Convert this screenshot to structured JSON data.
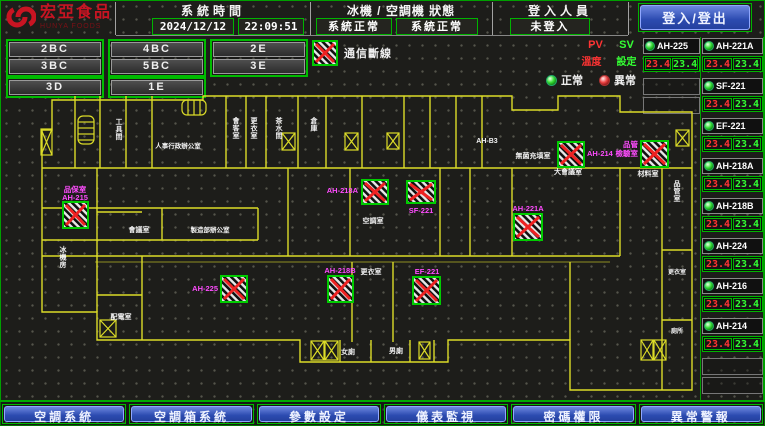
{
  "header": {
    "logo_title": "宏亞食品",
    "logo_subtitle": "HUNYA FOODS",
    "time_label": "系統時間",
    "date": "2024/12/12",
    "time": "22:09:51",
    "status_label": "冰機 / 空調機 狀態",
    "chiller_status": "系統正常",
    "ahu_status": "系統正常",
    "login_label": "登入人員",
    "login_status": "未登入",
    "login_button": "登入/登出"
  },
  "floor_buttons": {
    "groups": [
      [
        "2BC",
        "3BC"
      ],
      [
        "4BC",
        "5BC"
      ],
      [
        "2E",
        "3E"
      ]
    ],
    "row3": [
      "3D",
      "1E"
    ]
  },
  "legend": {
    "comm_lost": "通信斷線",
    "normal": "正常",
    "abnormal": "異常",
    "pv": "PV",
    "sv": "SV",
    "temp": "溫度",
    "set": "設定"
  },
  "equipment": {
    "col1": [
      {
        "name": "AH-225",
        "pv": "23.4",
        "sv": "23.4"
      }
    ],
    "col1_empty": 2,
    "col2": [
      {
        "name": "AH-221A",
        "pv": "23.4",
        "sv": "23.4"
      },
      {
        "name": "SF-221",
        "pv": "23.4",
        "sv": "23.4"
      },
      {
        "name": "EF-221",
        "pv": "23.4",
        "sv": "23.4"
      },
      {
        "name": "AH-218A",
        "pv": "23.4",
        "sv": "23.4"
      },
      {
        "name": "AH-218B",
        "pv": "23.4",
        "sv": "23.4"
      },
      {
        "name": "AH-224",
        "pv": "23.4",
        "sv": "23.4"
      },
      {
        "name": "AH-216",
        "pv": "23.4",
        "sv": "23.4"
      },
      {
        "name": "AH-214",
        "pv": "23.4",
        "sv": "23.4"
      }
    ],
    "col2_empty": 2
  },
  "bottom_nav": [
    "空調系統",
    "空調箱系統",
    "參數設定",
    "儀表監視",
    "密碼權限",
    "異常警報"
  ],
  "colors": {
    "accent_green": "#00bb00",
    "wall_yellow": "#dcdc28",
    "magenta": "#ff4cff",
    "pv_red": "#ff3333",
    "sv_green": "#33ff33"
  },
  "floorplan": {
    "room_labels": [
      {
        "t": "工具間",
        "x": 119,
        "y": 34,
        "v": true
      },
      {
        "t": "人事行政辦公室",
        "x": 178,
        "y": 58,
        "s": 6.5
      },
      {
        "t": "會客室",
        "x": 236,
        "y": 33,
        "v": true
      },
      {
        "t": "更衣室",
        "x": 254,
        "y": 33,
        "v": true
      },
      {
        "t": "茶水間",
        "x": 279,
        "y": 33,
        "v": true
      },
      {
        "t": "倉庫",
        "x": 314,
        "y": 33,
        "v": true
      },
      {
        "t": "AH-B3",
        "x": 487,
        "y": 53,
        "s": 7
      },
      {
        "t": "無菌充填室",
        "x": 533,
        "y": 68
      },
      {
        "t": "大會議室",
        "x": 568,
        "y": 84
      },
      {
        "t": "材料室",
        "x": 648,
        "y": 86
      },
      {
        "t": "品管室",
        "x": 677,
        "y": 96,
        "v": true
      },
      {
        "t": "會議室",
        "x": 139,
        "y": 142
      },
      {
        "t": "製造部辦公室",
        "x": 210,
        "y": 142,
        "s": 6.5
      },
      {
        "t": "空調室",
        "x": 373,
        "y": 133
      },
      {
        "t": "更衣室",
        "x": 371,
        "y": 184
      },
      {
        "t": "冰機房",
        "x": 63,
        "y": 162,
        "v": true
      },
      {
        "t": "配電室",
        "x": 121,
        "y": 229
      },
      {
        "t": "女廁",
        "x": 348,
        "y": 264
      },
      {
        "t": "男廁",
        "x": 396,
        "y": 263
      },
      {
        "t": "更衣室",
        "x": 677,
        "y": 184,
        "s": 6
      },
      {
        "t": "廁所",
        "x": 677,
        "y": 243,
        "s": 6
      }
    ],
    "markers": [
      {
        "id": "AH-215",
        "r": [
          63,
          112,
          25,
          26
        ],
        "labels": [
          {
            "t": "品保室",
            "x": 75,
            "y": 102
          },
          {
            "t": "AH-215",
            "x": 75,
            "y": 110
          }
        ]
      },
      {
        "id": "AH-225",
        "r": [
          221,
          186,
          26,
          26
        ],
        "labels": [
          {
            "t": "AH-225",
            "x": 218,
            "y": 201,
            "a": "end"
          }
        ]
      },
      {
        "id": "AH-218B",
        "r": [
          328,
          186,
          25,
          26
        ],
        "labels": [
          {
            "t": "AH-218B",
            "x": 340,
            "y": 183
          }
        ]
      },
      {
        "id": "EF-221",
        "r": [
          413,
          187,
          27,
          27
        ],
        "labels": [
          {
            "t": "EF-221",
            "x": 427,
            "y": 184
          }
        ]
      },
      {
        "id": "AH-218A",
        "r": [
          362,
          90,
          26,
          24
        ],
        "labels": [
          {
            "t": "AH-218A",
            "x": 358,
            "y": 103,
            "a": "end"
          }
        ]
      },
      {
        "id": "SF-221",
        "r": [
          407,
          91,
          28,
          22
        ],
        "labels": [
          {
            "t": "SF-221",
            "x": 421,
            "y": 123
          }
        ]
      },
      {
        "id": "AH-221A",
        "r": [
          514,
          124,
          28,
          26
        ],
        "labels": [
          {
            "t": "AH-221A",
            "x": 528,
            "y": 121
          }
        ]
      },
      {
        "id": "AH-214",
        "r": [
          558,
          52,
          26,
          25
        ],
        "labels": [
          {
            "t": "AH-214",
            "x": 587,
            "y": 66,
            "a": "start"
          }
        ]
      },
      {
        "id": "AH-216",
        "r": [
          641,
          51,
          27,
          26
        ],
        "labels": [
          {
            "t": "品管",
            "x": 638,
            "y": 57,
            "a": "end"
          },
          {
            "t": "檢驗室",
            "x": 638,
            "y": 66,
            "a": "end"
          }
        ]
      }
    ],
    "shafts": [
      [
        41,
        39,
        11,
        26
      ],
      [
        282,
        43,
        13,
        17
      ],
      [
        345,
        43,
        13,
        17
      ],
      [
        387,
        43,
        12,
        16
      ],
      [
        676,
        40,
        13,
        16
      ],
      [
        311,
        251,
        13,
        19
      ],
      [
        325,
        251,
        13,
        19
      ],
      [
        419,
        252,
        11,
        17
      ],
      [
        641,
        250,
        12,
        20
      ],
      [
        654,
        250,
        12,
        20
      ],
      [
        100,
        230,
        16,
        17
      ]
    ],
    "stairs": [
      [
        78,
        26,
        16,
        28,
        "v"
      ],
      [
        182,
        10,
        24,
        15,
        "h"
      ]
    ]
  }
}
